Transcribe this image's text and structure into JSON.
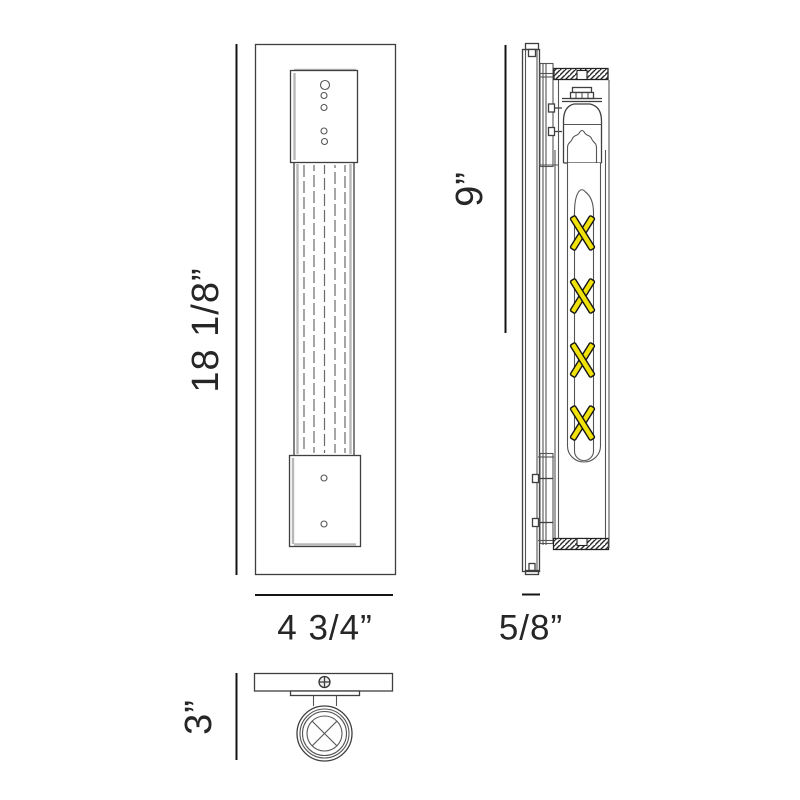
{
  "diagram": {
    "views": {
      "front": {
        "height_label": "18 1/8”",
        "width_label": "4 3/4”"
      },
      "side": {
        "height_label": "9”",
        "depth_label": "5/8”"
      },
      "top": {
        "depth_label": "3”"
      }
    },
    "colors": {
      "filament": "#f0e20a",
      "line": "#3f3f3f",
      "dim_text": "#262626",
      "background": "#ffffff"
    }
  }
}
